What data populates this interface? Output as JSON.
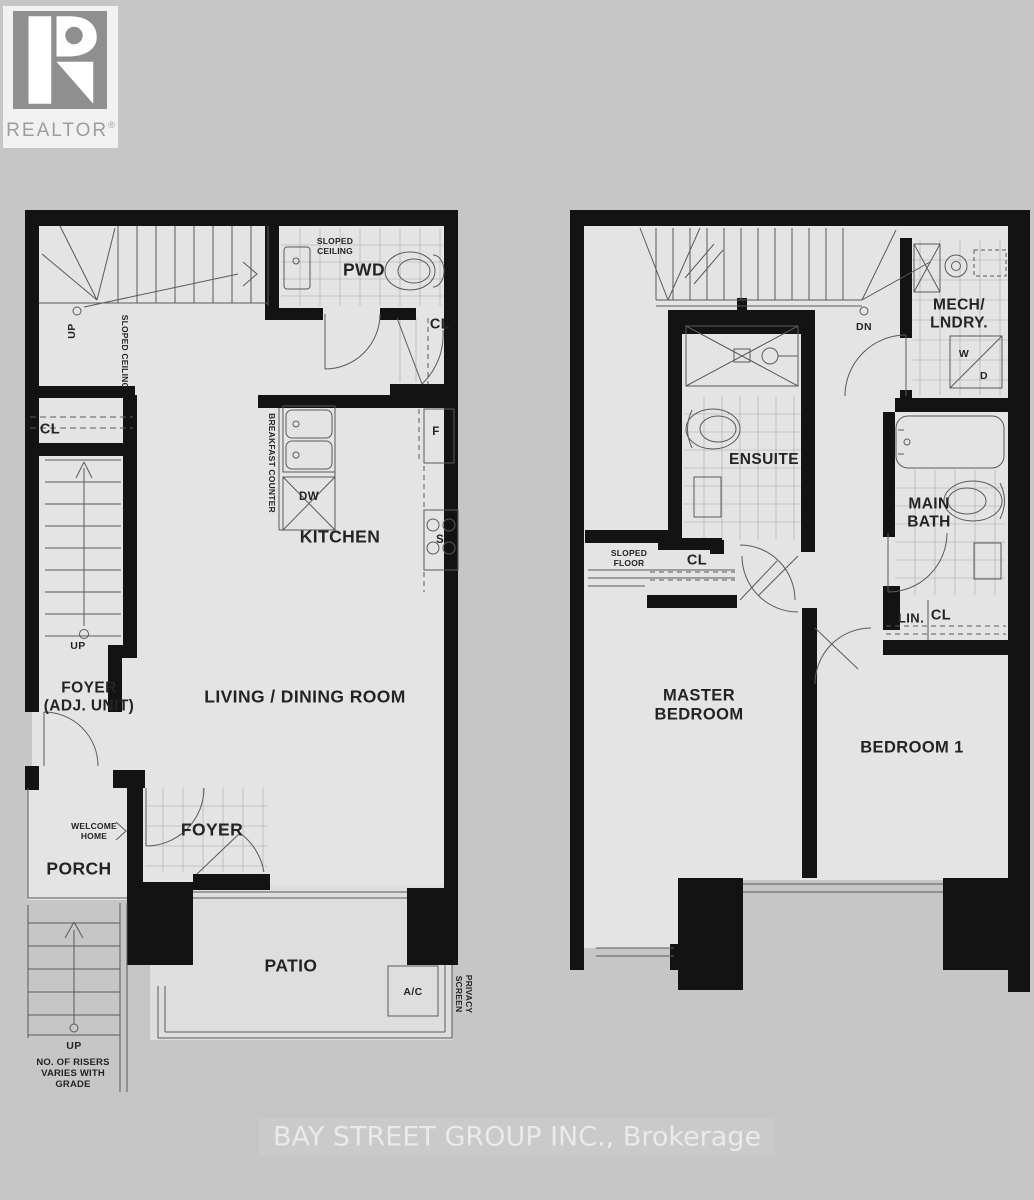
{
  "brand": {
    "name": "REALTOR",
    "reg": "®",
    "watermark": "BAY STREET GROUP INC., Brokerage"
  },
  "floor1": {
    "stair_up": "UP",
    "sloped_ceiling_stair": "SLOPED CEILING",
    "sloped_ceiling_pwd": "SLOPED\nCEILING",
    "powder_room": "PWD",
    "closet_pwd": "CL",
    "breakfast_counter": "BREAKFAST COUNTER",
    "dishwasher": "DW",
    "kitchen": "KITCHEN",
    "fridge": "F",
    "stove": "S",
    "closet_left": "CL",
    "stair2_up": "UP",
    "foyer_adj_unit": "FOYER\n(ADJ. UNIT)",
    "living_dining": "LIVING / DINING ROOM",
    "welcome_home": "WELCOME\nHOME",
    "porch": "PORCH",
    "foyer": "FOYER",
    "patio": "PATIO",
    "ac_unit": "A/C",
    "privacy_screen": "PRIVACY\nSCREEN",
    "ext_stair_up": "UP",
    "risers_note": "NO. OF RISERS\nVARIES WITH\nGRADE"
  },
  "floor2": {
    "stair_dn": "DN",
    "mech_laundry": "MECH/\nLNDRY.",
    "washer": "W",
    "dryer": "D",
    "ensuite": "ENSUITE",
    "sloped_floor": "SLOPED\nFLOOR",
    "closet_hall": "CL",
    "main_bath": "MAIN\nBATH",
    "linen": "LIN.",
    "closet_linen": "CL",
    "master_bedroom": "MASTER\nBEDROOM",
    "bedroom_1": "BEDROOM 1"
  },
  "colors": {
    "background": "#c6c6c6",
    "floor": "#e4e4e4",
    "wall": "#131313",
    "thin_line": "#5a5a5a",
    "tile_line": "#a8a8a8",
    "label": "#242424",
    "watermark_text": "#f0f0f0",
    "logo_gray": "#8f8f8f"
  }
}
